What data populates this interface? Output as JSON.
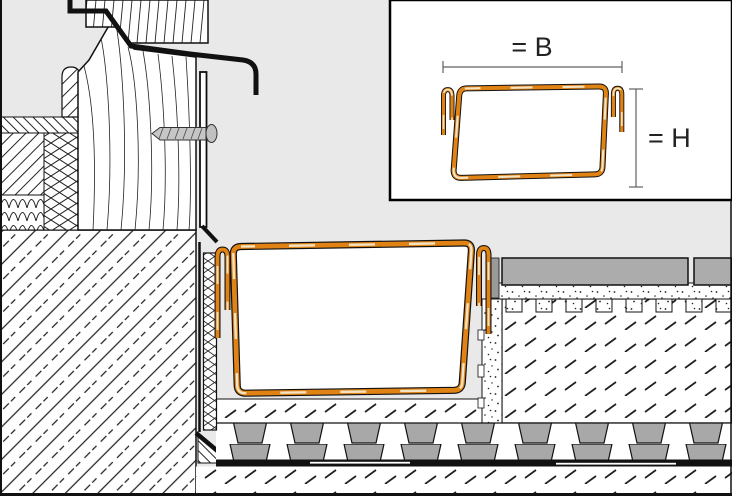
{
  "drawing": {
    "type": "construction-section-detail",
    "subject": "balcony door threshold with drainage gutter profile, tile assembly and waterproofing"
  },
  "inset": {
    "width_dimension_label": "= B",
    "height_dimension_label": "= H"
  },
  "colors": {
    "background": "#E9E9EA",
    "inset_background": "#FFFFFF",
    "profile_orange": "#E08214",
    "profile_tan": "#F3E3C3",
    "tile_gray": "#ACACAC",
    "trapezoid_gray": "#A8A8A8",
    "line_black": "#1A1A1A",
    "dimension_gray": "#606060"
  }
}
